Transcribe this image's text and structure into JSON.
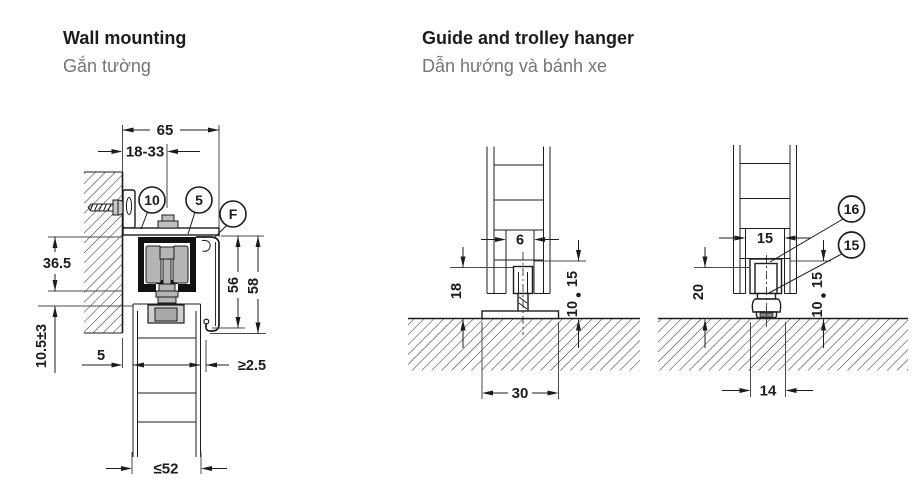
{
  "wall_mounting": {
    "title": "Wall mounting",
    "subtitle": "Gắn tường",
    "callouts": {
      "bracket": "10",
      "track": "5",
      "fascia": "F"
    },
    "dims": {
      "overall_width": "65",
      "bracket_adjust_range": "18-33",
      "track_height": "36.5",
      "door_top_clearance": "10.5±3",
      "wall_to_door_gap": "5",
      "fascia_height_inner": "56",
      "fascia_height_outer": "58",
      "door_to_fascia_gap": "≥2.5",
      "max_door_thickness": "≤52"
    }
  },
  "guide_trolley": {
    "title": "Guide and trolley hanger",
    "subtitle": "Dẫn hướng và bánh xe",
    "groove_guide": {
      "groove_width": "6",
      "guide_height": "18",
      "engagement_depth": "15",
      "floor_clearance": "10",
      "base_plate_width": "30"
    },
    "roller_guide": {
      "groove_width": "15",
      "guide_height": "20",
      "engagement_depth": "15",
      "floor_clearance": "10",
      "roller_width": "14",
      "callouts": {
        "guide_block": "16",
        "floor_roller": "15"
      }
    }
  },
  "colors": {
    "line": "#1c1c1c",
    "subtitle_gray": "#757575",
    "roller_gray": "#b5b5b5",
    "fitting_gray": "#cfcfcf",
    "fitting_dark_gray": "#a8a8a8"
  }
}
